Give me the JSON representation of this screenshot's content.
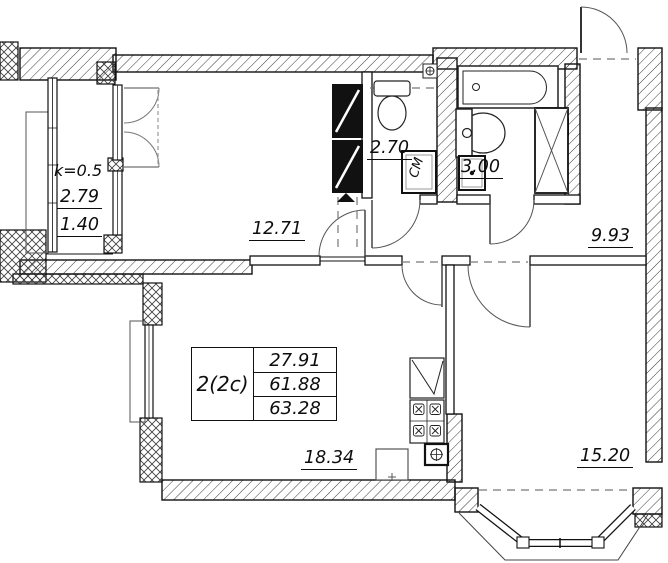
{
  "plan": {
    "apartment": {
      "type_label": "2(2c)",
      "living_area": "27.91",
      "total_area": "61.88",
      "total_area_with_balcony": "63.28"
    },
    "rooms": {
      "living_room": "12.71",
      "wc": "2.70",
      "bathroom": "3.00",
      "hallway": "9.93",
      "kitchen": "18.34",
      "bedroom": "15.20"
    },
    "balcony": {
      "coefficient": "k=0.5",
      "area": "2.79",
      "reduced_area": "1.40"
    },
    "labels": {
      "washing_machine": "СМ"
    },
    "colors": {
      "line": "#111111",
      "hatch": "#3a3a3a",
      "dash": "#777777"
    }
  }
}
